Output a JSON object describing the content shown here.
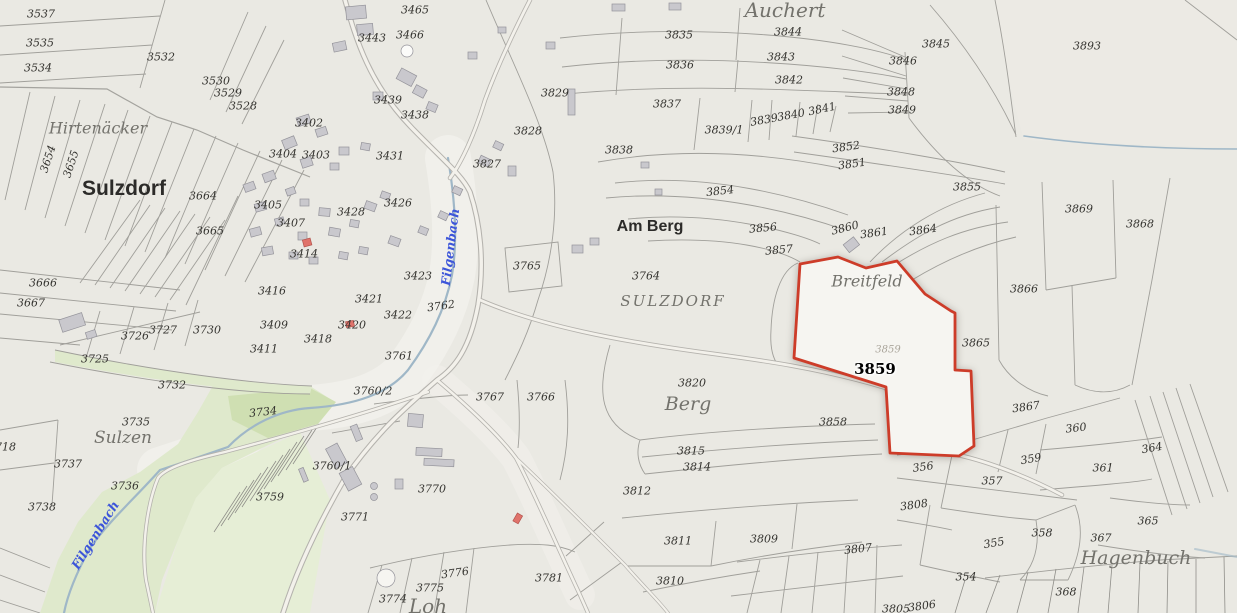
{
  "map": {
    "type": "cadastral-parcel-map",
    "selected_parcel": {
      "t": "3859",
      "x": 875,
      "y": 369
    },
    "selected_parcel_faded": {
      "t": "3859",
      "x": 888,
      "y": 350
    },
    "colors": {
      "background": "#eae9e3",
      "parcel_line": "#a09f9a",
      "building": "#c9c8cd",
      "building_red": "#e0736b",
      "green_area": "#dfe9cc",
      "green_area_dark": "#cfdfb2",
      "road_fill": "#f3f1eb",
      "road_casing": "#b4b2ad",
      "stream": "#9fb7c7",
      "stream_label": "#3c55d9",
      "selected_outline": "#cd3c29",
      "selected_fill": "#f6f5f1"
    },
    "labels": {
      "parcels": [
        {
          "t": "3537",
          "x": 41,
          "y": 14
        },
        {
          "t": "3535",
          "x": 40,
          "y": 43
        },
        {
          "t": "3534",
          "x": 38,
          "y": 68
        },
        {
          "t": "3532",
          "x": 161,
          "y": 57
        },
        {
          "t": "3530",
          "x": 216,
          "y": 81
        },
        {
          "t": "3529",
          "x": 228,
          "y": 93
        },
        {
          "t": "3528",
          "x": 243,
          "y": 106
        },
        {
          "t": "3654",
          "x": 48,
          "y": 159,
          "r": -72
        },
        {
          "t": "3655",
          "x": 71,
          "y": 164,
          "r": -72
        },
        {
          "t": "3465",
          "x": 415,
          "y": 10
        },
        {
          "t": "3466",
          "x": 410,
          "y": 35
        },
        {
          "t": "3443",
          "x": 372,
          "y": 38
        },
        {
          "t": "3439",
          "x": 388,
          "y": 100
        },
        {
          "t": "3438",
          "x": 415,
          "y": 115
        },
        {
          "t": "3402",
          "x": 309,
          "y": 123
        },
        {
          "t": "3404",
          "x": 283,
          "y": 154
        },
        {
          "t": "3403",
          "x": 316,
          "y": 155
        },
        {
          "t": "3431",
          "x": 390,
          "y": 156
        },
        {
          "t": "3829",
          "x": 555,
          "y": 93
        },
        {
          "t": "3828",
          "x": 528,
          "y": 131
        },
        {
          "t": "3827",
          "x": 487,
          "y": 164
        },
        {
          "t": "3835",
          "x": 679,
          "y": 35
        },
        {
          "t": "3836",
          "x": 680,
          "y": 65
        },
        {
          "t": "3837",
          "x": 667,
          "y": 104
        },
        {
          "t": "3838",
          "x": 619,
          "y": 150
        },
        {
          "t": "3839",
          "x": 764,
          "y": 120,
          "r": -10
        },
        {
          "t": "3839/1",
          "x": 724,
          "y": 130
        },
        {
          "t": "3840",
          "x": 791,
          "y": 115,
          "r": -10
        },
        {
          "t": "3841",
          "x": 822,
          "y": 109,
          "r": -12
        },
        {
          "t": "3842",
          "x": 789,
          "y": 80
        },
        {
          "t": "3843",
          "x": 781,
          "y": 57
        },
        {
          "t": "3844",
          "x": 788,
          "y": 32
        },
        {
          "t": "3845",
          "x": 936,
          "y": 44
        },
        {
          "t": "3846",
          "x": 903,
          "y": 61
        },
        {
          "t": "3848",
          "x": 901,
          "y": 92
        },
        {
          "t": "3849",
          "x": 902,
          "y": 110
        },
        {
          "t": "3893",
          "x": 1087,
          "y": 46
        },
        {
          "t": "3852",
          "x": 846,
          "y": 147,
          "r": -8
        },
        {
          "t": "3851",
          "x": 852,
          "y": 164,
          "r": -8
        },
        {
          "t": "3854",
          "x": 720,
          "y": 191,
          "r": -6
        },
        {
          "t": "3855",
          "x": 967,
          "y": 187
        },
        {
          "t": "3856",
          "x": 763,
          "y": 228,
          "r": -5
        },
        {
          "t": "3857",
          "x": 779,
          "y": 250,
          "r": -5
        },
        {
          "t": "3860",
          "x": 845,
          "y": 228,
          "r": -14
        },
        {
          "t": "3861",
          "x": 874,
          "y": 233,
          "r": -8
        },
        {
          "t": "3864",
          "x": 923,
          "y": 230,
          "r": -8
        },
        {
          "t": "3865",
          "x": 976,
          "y": 343
        },
        {
          "t": "3866",
          "x": 1024,
          "y": 289
        },
        {
          "t": "3869",
          "x": 1079,
          "y": 209
        },
        {
          "t": "3868",
          "x": 1140,
          "y": 224
        },
        {
          "t": "3664",
          "x": 203,
          "y": 196
        },
        {
          "t": "3405",
          "x": 268,
          "y": 205
        },
        {
          "t": "3407",
          "x": 291,
          "y": 223
        },
        {
          "t": "3665",
          "x": 210,
          "y": 231
        },
        {
          "t": "3414",
          "x": 304,
          "y": 254
        },
        {
          "t": "3666",
          "x": 43,
          "y": 283
        },
        {
          "t": "3667",
          "x": 31,
          "y": 303
        },
        {
          "t": "3416",
          "x": 272,
          "y": 291
        },
        {
          "t": "3409",
          "x": 274,
          "y": 325
        },
        {
          "t": "3411",
          "x": 264,
          "y": 349
        },
        {
          "t": "3418",
          "x": 318,
          "y": 339
        },
        {
          "t": "3420",
          "x": 352,
          "y": 325
        },
        {
          "t": "3421",
          "x": 369,
          "y": 299
        },
        {
          "t": "3422",
          "x": 398,
          "y": 315
        },
        {
          "t": "3423",
          "x": 418,
          "y": 276
        },
        {
          "t": "3426",
          "x": 398,
          "y": 203
        },
        {
          "t": "3428",
          "x": 351,
          "y": 212
        },
        {
          "t": "3727",
          "x": 163,
          "y": 330
        },
        {
          "t": "3726",
          "x": 135,
          "y": 336
        },
        {
          "t": "3730",
          "x": 207,
          "y": 330
        },
        {
          "t": "3725",
          "x": 95,
          "y": 359
        },
        {
          "t": "3732",
          "x": 172,
          "y": 385
        },
        {
          "t": "3762",
          "x": 441,
          "y": 306,
          "r": -8
        },
        {
          "t": "3761",
          "x": 399,
          "y": 356
        },
        {
          "t": "3765",
          "x": 527,
          "y": 266
        },
        {
          "t": "3764",
          "x": 646,
          "y": 276
        },
        {
          "t": "3760/2",
          "x": 373,
          "y": 391
        },
        {
          "t": "3760/1",
          "x": 332,
          "y": 466
        },
        {
          "t": "3759",
          "x": 270,
          "y": 497
        },
        {
          "t": "3767",
          "x": 490,
          "y": 397
        },
        {
          "t": "3766",
          "x": 541,
          "y": 397
        },
        {
          "t": "3770",
          "x": 432,
          "y": 489
        },
        {
          "t": "3771",
          "x": 355,
          "y": 517
        },
        {
          "t": "3774",
          "x": 393,
          "y": 599
        },
        {
          "t": "3775",
          "x": 430,
          "y": 588
        },
        {
          "t": "3776",
          "x": 455,
          "y": 573,
          "r": -8
        },
        {
          "t": "3781",
          "x": 549,
          "y": 578
        },
        {
          "t": "3820",
          "x": 692,
          "y": 383
        },
        {
          "t": "3815",
          "x": 691,
          "y": 451
        },
        {
          "t": "3814",
          "x": 697,
          "y": 467
        },
        {
          "t": "3812",
          "x": 637,
          "y": 491
        },
        {
          "t": "3811",
          "x": 678,
          "y": 541
        },
        {
          "t": "3809",
          "x": 764,
          "y": 539
        },
        {
          "t": "3810",
          "x": 670,
          "y": 581
        },
        {
          "t": "3807",
          "x": 858,
          "y": 549,
          "r": -6
        },
        {
          "t": "3808",
          "x": 914,
          "y": 505,
          "r": -8
        },
        {
          "t": "3858",
          "x": 833,
          "y": 422
        },
        {
          "t": "3735",
          "x": 136,
          "y": 422
        },
        {
          "t": "3734",
          "x": 263,
          "y": 412,
          "r": -6
        },
        {
          "t": "3737",
          "x": 68,
          "y": 464
        },
        {
          "t": "3736",
          "x": 125,
          "y": 486
        },
        {
          "t": "3738",
          "x": 42,
          "y": 507
        },
        {
          "t": "3718",
          "x": 2,
          "y": 447
        },
        {
          "t": "354",
          "x": 966,
          "y": 577
        },
        {
          "t": "355",
          "x": 994,
          "y": 543,
          "r": -10
        },
        {
          "t": "356",
          "x": 923,
          "y": 467,
          "r": -8
        },
        {
          "t": "357",
          "x": 992,
          "y": 481
        },
        {
          "t": "358",
          "x": 1042,
          "y": 533
        },
        {
          "t": "359",
          "x": 1031,
          "y": 459,
          "r": -10
        },
        {
          "t": "360",
          "x": 1076,
          "y": 428,
          "r": -6
        },
        {
          "t": "361",
          "x": 1103,
          "y": 468
        },
        {
          "t": "364",
          "x": 1152,
          "y": 448,
          "r": -10
        },
        {
          "t": "365",
          "x": 1148,
          "y": 521
        },
        {
          "t": "367",
          "x": 1101,
          "y": 538
        },
        {
          "t": "368",
          "x": 1066,
          "y": 592
        },
        {
          "t": "3805",
          "x": 896,
          "y": 609
        },
        {
          "t": "3806",
          "x": 922,
          "y": 606,
          "r": -8
        },
        {
          "t": "3867",
          "x": 1026,
          "y": 407,
          "r": -8
        }
      ],
      "places": [
        {
          "t": "Hirtenäcker",
          "x": 98,
          "y": 128,
          "s": 16
        },
        {
          "t": "Sulzdorf",
          "x": 124,
          "y": 189,
          "s": 21,
          "b": true
        },
        {
          "t": "Sulzen",
          "x": 123,
          "y": 438,
          "s": 17
        },
        {
          "t": "Auchert",
          "x": 785,
          "y": 10,
          "s": 20
        },
        {
          "t": "Am Berg",
          "x": 650,
          "y": 227,
          "s": 16,
          "b": true
        },
        {
          "t": "SULZDORF",
          "x": 673,
          "y": 301,
          "s": 15,
          "ls": 2
        },
        {
          "t": "Breitfeld",
          "x": 867,
          "y": 281,
          "s": 16
        },
        {
          "t": "Berg",
          "x": 688,
          "y": 404,
          "s": 19
        },
        {
          "t": "Hagenbuch",
          "x": 1136,
          "y": 558,
          "s": 19
        },
        {
          "t": "Loh",
          "x": 428,
          "y": 606,
          "s": 20
        }
      ],
      "streams": [
        {
          "t": "Filgenbach",
          "x": 450,
          "y": 247,
          "r": -83
        },
        {
          "t": "Filgenbach",
          "x": 95,
          "y": 535,
          "r": -58
        }
      ]
    }
  }
}
